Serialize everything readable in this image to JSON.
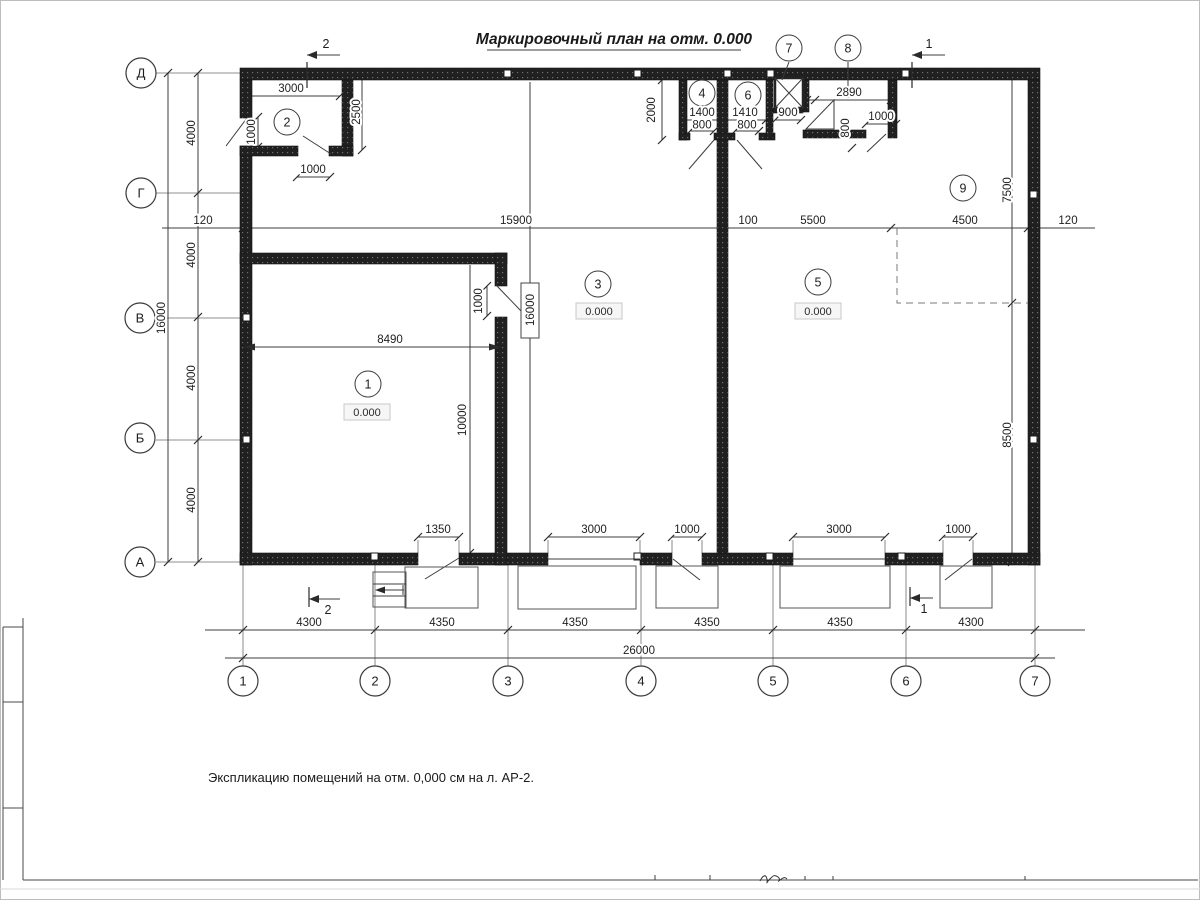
{
  "title": "Маркировочный план на отм. 0.000",
  "note": "Экспликацию помещений на отм. 0,000 см на л. АР-2.",
  "grid": {
    "rows": [
      "Д",
      "Г",
      "В",
      "Б",
      "А"
    ],
    "cols": [
      "1",
      "2",
      "3",
      "4",
      "5",
      "6",
      "7"
    ]
  },
  "rooms": {
    "r1": "1",
    "r2": "2",
    "r3": "3",
    "r4": "4",
    "r5": "5",
    "r6": "6",
    "r7": "7",
    "r8": "8",
    "r9": "9"
  },
  "elevations": {
    "room1": "0.000",
    "room3": "0.000",
    "room5": "0.000"
  },
  "sections": {
    "cut1": "1",
    "cut2": "2"
  },
  "dims": {
    "room2_width": "3000",
    "room2_depth": "2500",
    "entry_door": "1000",
    "room2_door": "1000",
    "top_offset_left": "120",
    "top_span_left": "15900",
    "partition": "100",
    "top_span_mid": "5500",
    "top_span_right": "4500",
    "top_offset_right": "120",
    "wc_depth": "2000",
    "room4_width": "1400",
    "room4_door": "800",
    "room6_width": "1410",
    "room6_door": "800",
    "shaft_width": "900",
    "room8_width": "2890",
    "ramp_height": "800",
    "room8_door": "1000",
    "right_upper": "7500",
    "right_lower": "8500",
    "bay1": "4000",
    "bay2": "4000",
    "bay3": "4000",
    "bay4": "4000",
    "left_total": "16000",
    "room1_width": "8490",
    "room1_door": "1000",
    "interior_height": "16000",
    "room1_depth": "10000",
    "opening1": "1350",
    "opening2": "3000",
    "opening3": "1000",
    "opening4": "3000",
    "opening5": "1000",
    "span1": "4300",
    "span2": "4350",
    "span3": "4350",
    "span4": "4350",
    "span5": "4350",
    "span6": "4300",
    "total_width": "26000"
  }
}
